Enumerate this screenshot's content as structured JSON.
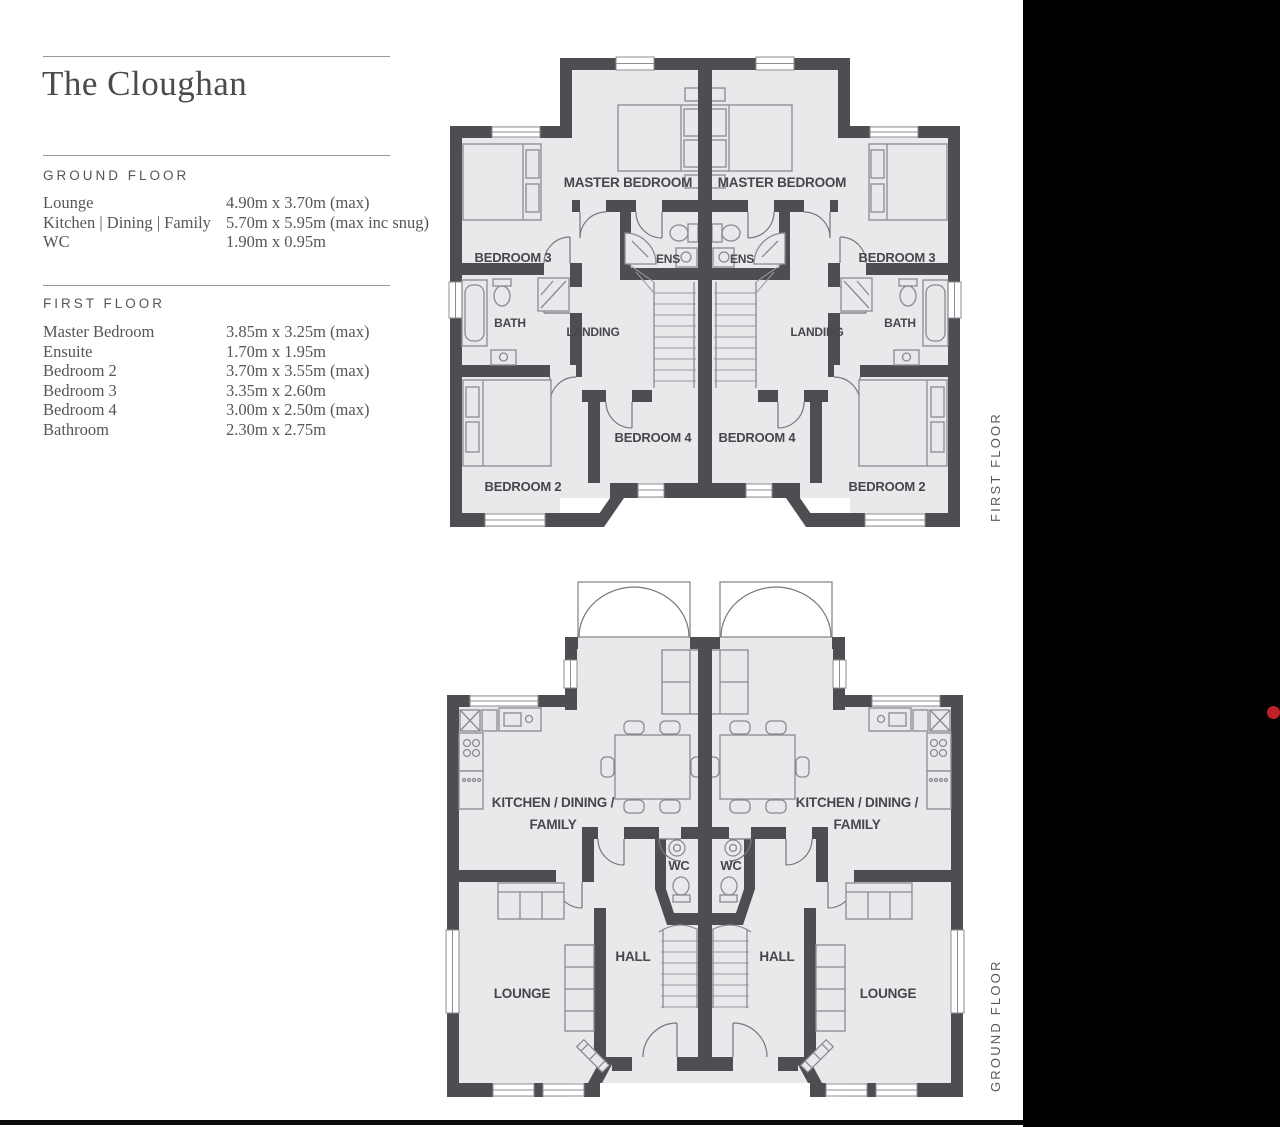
{
  "colors": {
    "wall": "#4e4e52",
    "floor": "#e9e9eb",
    "side_panel": "#000000",
    "marker_dot": "#c0202a"
  },
  "info_panel": {
    "title": "The Cloughan",
    "sections": [
      {
        "heading": "GROUND FLOOR",
        "rows": [
          {
            "label": "Lounge",
            "value": "4.90m x 3.70m (max)"
          },
          {
            "label": "Kitchen | Dining | Family",
            "value": "5.70m x 5.95m (max inc snug)"
          },
          {
            "label": "WC",
            "value": "1.90m x 0.95m"
          }
        ]
      },
      {
        "heading": "FIRST FLOOR",
        "rows": [
          {
            "label": "Master Bedroom",
            "value": "3.85m x 3.25m (max)"
          },
          {
            "label": "Ensuite",
            "value": "1.70m x 1.95m"
          },
          {
            "label": "Bedroom 2",
            "value": "3.70m x 3.55m (max)"
          },
          {
            "label": "Bedroom 3",
            "value": "3.35m x 2.60m"
          },
          {
            "label": "Bedroom 4",
            "value": "3.00m x 2.50m (max)"
          },
          {
            "label": "Bathroom",
            "value": "2.30m x 2.75m"
          }
        ]
      }
    ]
  },
  "first_floor_plan": {
    "side_label": "FIRST FLOOR",
    "labels": {
      "master_bedroom": "MASTER BEDROOM",
      "bedroom_2": "BEDROOM 2",
      "bedroom_3": "BEDROOM 3",
      "bedroom_4": "BEDROOM 4",
      "ensuite": "ENS",
      "bath": "BATH",
      "landing": "LANDING"
    }
  },
  "ground_floor_plan": {
    "side_label": "GROUND FLOOR",
    "labels": {
      "kitchen_line_1": "KITCHEN / DINING /",
      "kitchen_line_2": "FAMILY",
      "wc": "WC",
      "hall": "HALL",
      "lounge": "LOUNGE"
    }
  }
}
